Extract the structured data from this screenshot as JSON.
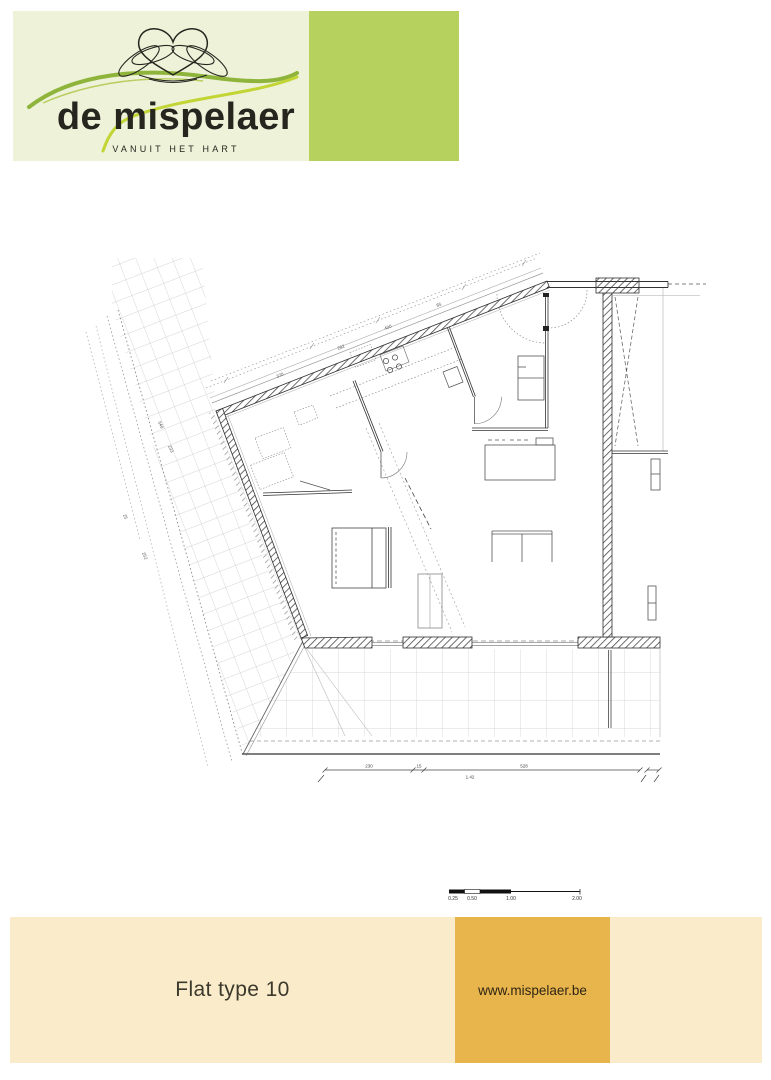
{
  "page": {
    "background": "#ffffff"
  },
  "logo": {
    "brand": "de mispelaer",
    "tagline": "VANUIT HET HART",
    "panel_bg": "#edf2d8",
    "accent_square": "#b7d15f",
    "ink": "#26261f",
    "swoosh_green": "#8fb43c",
    "swoosh_lime": "#c3d435"
  },
  "plan": {
    "scale_bar": {
      "labels": [
        "0.25",
        "0.50",
        "1.00",
        "2.00"
      ]
    },
    "dimensions": {
      "facade": [
        "370",
        "282",
        "400",
        "85"
      ],
      "left": [
        "549",
        "233",
        "25",
        "252"
      ],
      "bottom": [
        "230",
        "15",
        "528",
        "1.42"
      ]
    }
  },
  "footer": {
    "title": "Flat type 10",
    "website": "www.mispelaer.be",
    "bar_bg": "#faecca",
    "accent_square": "#e7b54b"
  }
}
